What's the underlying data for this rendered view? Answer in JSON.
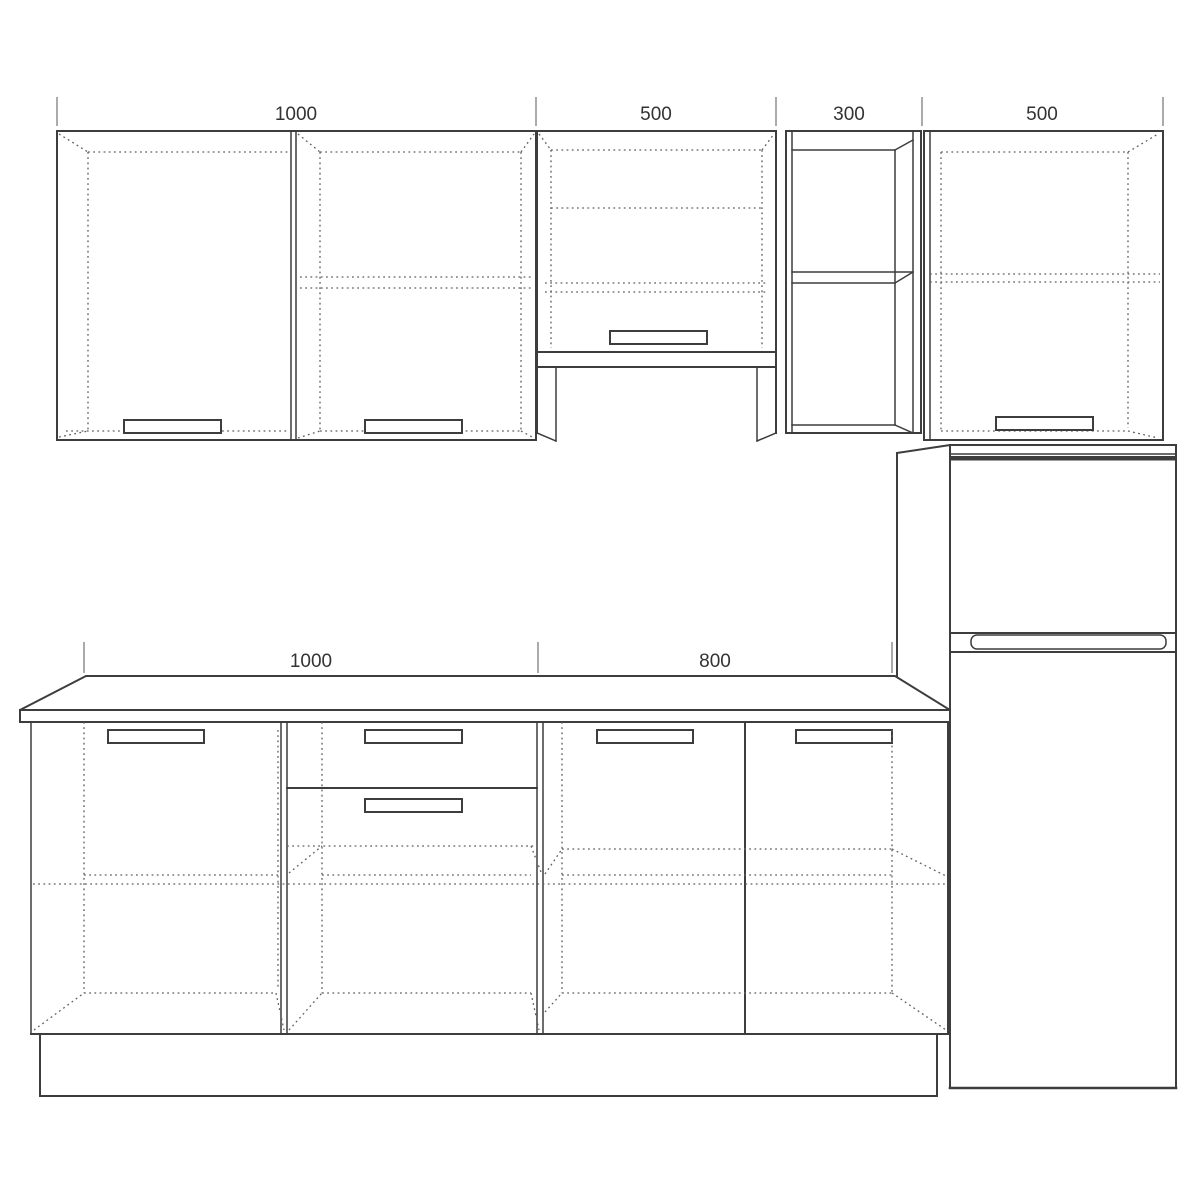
{
  "drawing": {
    "type": "kitchen-cabinet-elevation",
    "colors": {
      "background": "#ffffff",
      "line": "#3d3d3d",
      "dotted_line": "#5f5f5f",
      "tick": "#8f8f8f",
      "label_text": "#333333"
    },
    "dimensions": {
      "top": [
        {
          "label": "1000"
        },
        {
          "label": "500"
        },
        {
          "label": "300"
        },
        {
          "label": "500"
        }
      ],
      "bottom": [
        {
          "label": "1000"
        },
        {
          "label": "800"
        }
      ]
    }
  }
}
